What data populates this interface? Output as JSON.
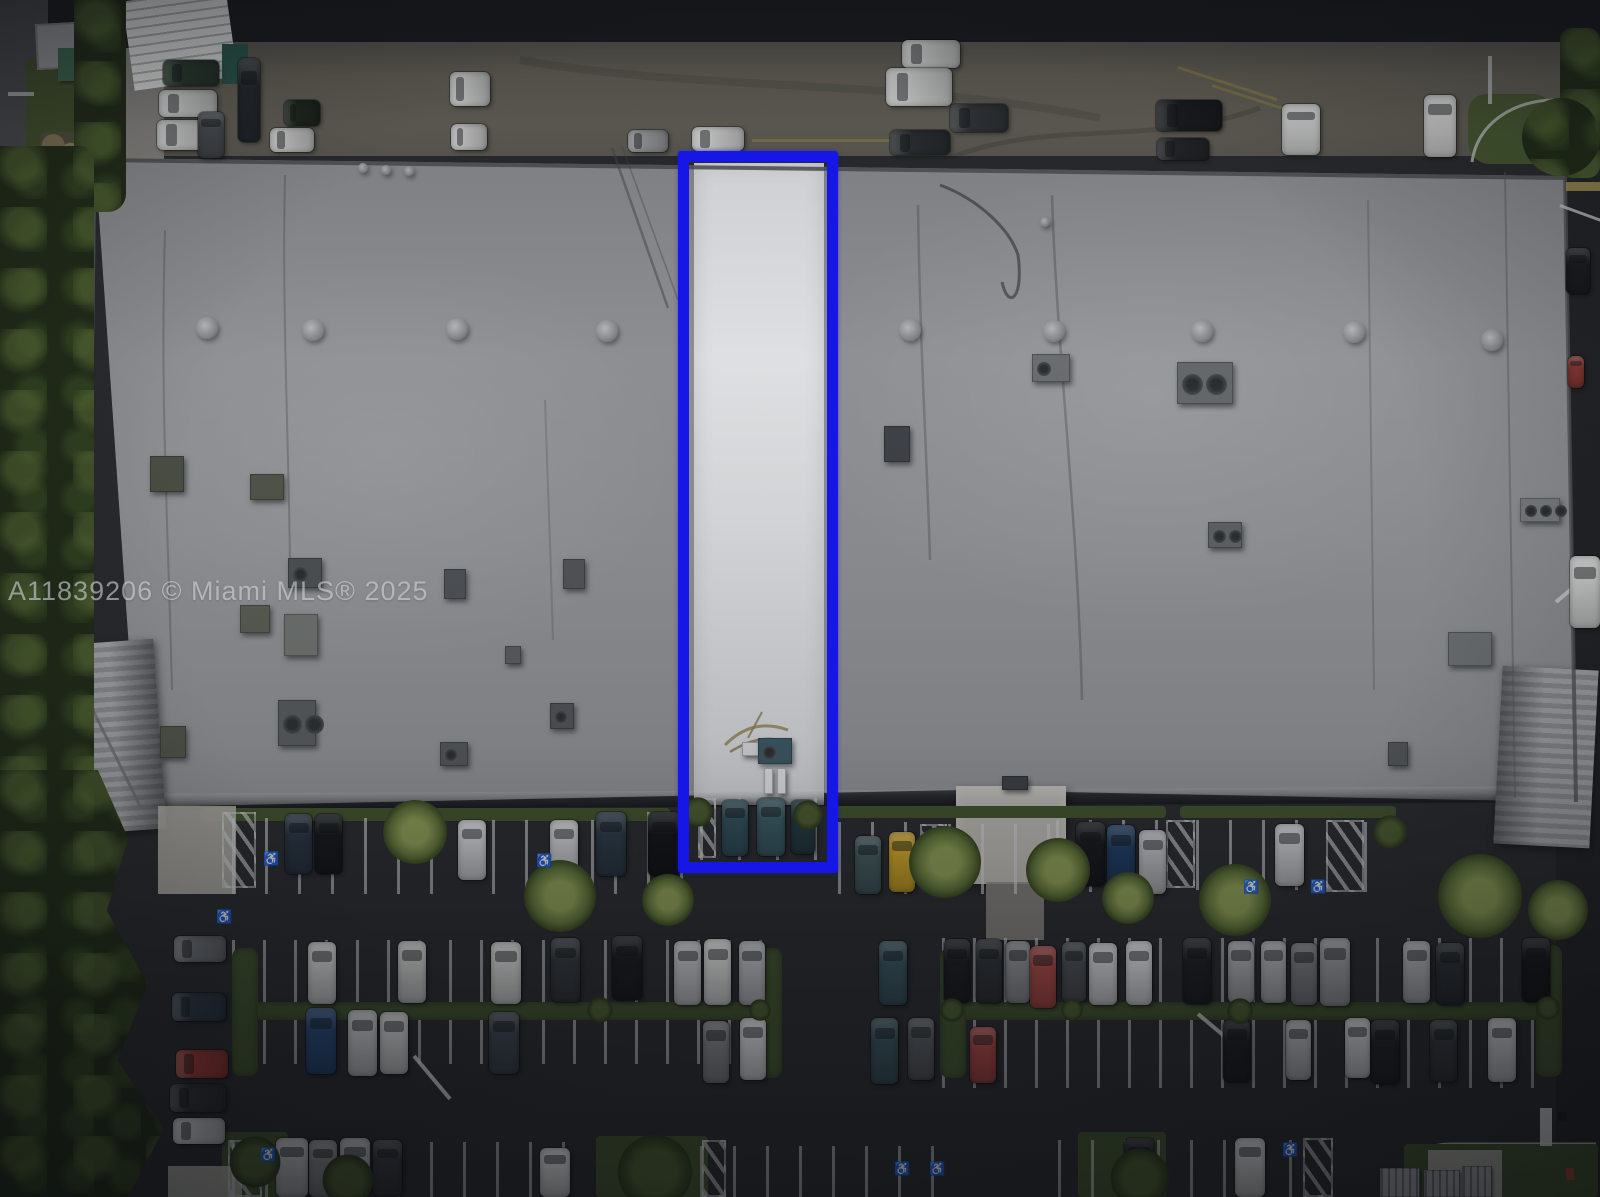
{
  "watermark": {
    "text": "A11839206 © Miami MLS® 2025"
  },
  "colors": {
    "asphalt_road": "#1b1d20",
    "asphalt_lot": "#2a2c30",
    "apron": "#686459",
    "roof": "#919396",
    "roof_white": "#e4e6e8",
    "blue": "#1617e6",
    "grass": "#41522e",
    "tree": "#232d19",
    "stripe": "#c9ccce",
    "canopy": "#9b9d9f",
    "concrete": "#b0aea6",
    "watermark_color": "#cdd2d6"
  },
  "highlight_unit": {
    "x": 678,
    "y": 151,
    "w": 160,
    "h": 722,
    "border_px": 11
  },
  "scene": {
    "stripes": [
      [
        232,
        818,
        230,
        76,
        33
      ],
      [
        492,
        820,
        120,
        74,
        33
      ],
      [
        614,
        812,
        80,
        82,
        33
      ],
      [
        700,
        798,
        118,
        62,
        38
      ],
      [
        838,
        822,
        82,
        72,
        33
      ],
      [
        948,
        824,
        108,
        70,
        33
      ],
      [
        1056,
        820,
        116,
        72,
        33
      ],
      [
        1196,
        820,
        130,
        70,
        33
      ],
      [
        1364,
        822,
        32,
        70,
        33
      ],
      [
        232,
        940,
        534,
        66,
        31
      ],
      [
        942,
        938,
        616,
        70,
        31
      ],
      [
        232,
        1004,
        534,
        60,
        31
      ],
      [
        942,
        1018,
        616,
        70,
        31
      ],
      [
        232,
        1142,
        362,
        55,
        33
      ],
      [
        700,
        1146,
        262,
        51,
        33
      ],
      [
        1058,
        1140,
        260,
        57,
        33
      ]
    ],
    "hatches": [
      [
        222,
        812,
        34,
        76
      ],
      [
        920,
        824,
        27,
        64
      ],
      [
        1166,
        820,
        29,
        68
      ],
      [
        1326,
        820,
        38,
        72
      ],
      [
        698,
        798,
        18,
        60
      ],
      [
        228,
        1140,
        34,
        57
      ],
      [
        702,
        1140,
        24,
        57
      ],
      [
        1303,
        1138,
        30,
        59
      ]
    ],
    "medians": [
      [
        232,
        1002,
        534,
        18
      ],
      [
        940,
        1002,
        618,
        18
      ]
    ],
    "median_caps": [
      [
        232,
        948,
        26,
        128
      ],
      [
        756,
        948,
        26,
        130
      ],
      [
        940,
        948,
        26,
        130
      ],
      [
        1536,
        945,
        26,
        132
      ]
    ],
    "grass_patches": [
      [
        200,
        808,
        470,
        13
      ],
      [
        836,
        806,
        330,
        12
      ],
      [
        1180,
        806,
        216,
        12
      ],
      [
        596,
        1136,
        112,
        61
      ],
      [
        1078,
        1132,
        88,
        65
      ],
      [
        222,
        1132,
        66,
        65
      ],
      [
        1404,
        1144,
        194,
        53
      ]
    ],
    "concrete_patches": [
      [
        158,
        806,
        78,
        88
      ],
      [
        168,
        1166,
        74,
        31
      ],
      [
        1428,
        1150,
        74,
        47
      ]
    ],
    "cars": [
      [
        163,
        60,
        56,
        26,
        "#2c3d30"
      ],
      [
        159,
        90,
        58,
        27,
        "#d6d7d5"
      ],
      [
        157,
        120,
        58,
        30,
        "#d0d1cf"
      ],
      [
        238,
        58,
        22,
        84,
        "#262b2f"
      ],
      [
        198,
        112,
        26,
        46,
        "#4a4e52"
      ],
      [
        284,
        100,
        36,
        26,
        "#20291f"
      ],
      [
        270,
        128,
        44,
        24,
        "#cfd0ce"
      ],
      [
        628,
        130,
        40,
        22,
        "#9a9c9e"
      ],
      [
        692,
        127,
        52,
        24,
        "#d4d5d3"
      ],
      [
        450,
        72,
        40,
        34,
        "#dadbd9"
      ],
      [
        451,
        124,
        36,
        26,
        "#cdcecc"
      ],
      [
        902,
        40,
        58,
        28,
        "#d7d8d6"
      ],
      [
        886,
        68,
        66,
        38,
        "#dddedc"
      ],
      [
        950,
        104,
        58,
        28,
        "#33373b"
      ],
      [
        890,
        130,
        60,
        25,
        "#2b2f33"
      ],
      [
        1156,
        100,
        66,
        31,
        "#1a1c1f"
      ],
      [
        1157,
        138,
        52,
        22,
        "#24272a"
      ],
      [
        1282,
        104,
        38,
        51,
        "#d9dad8"
      ],
      [
        1424,
        95,
        32,
        62,
        "#e1e1df"
      ],
      [
        1566,
        248,
        24,
        46,
        "#1b1e21"
      ],
      [
        1568,
        356,
        16,
        32,
        "#8c3a34"
      ],
      [
        1570,
        556,
        30,
        72,
        "#d8d9d7"
      ],
      [
        285,
        814,
        27,
        60,
        "#2a3542"
      ],
      [
        315,
        814,
        27,
        60,
        "#17191c"
      ],
      [
        458,
        820,
        28,
        60,
        "#cbccce"
      ],
      [
        550,
        820,
        28,
        60,
        "#c7c8ca"
      ],
      [
        596,
        812,
        30,
        64,
        "#2c3a46"
      ],
      [
        648,
        812,
        32,
        64,
        "#131518"
      ],
      [
        722,
        800,
        26,
        56,
        "#32505a"
      ],
      [
        757,
        798,
        28,
        58,
        "#3a5a64"
      ],
      [
        791,
        800,
        24,
        54,
        "#263a42"
      ],
      [
        855,
        836,
        26,
        58,
        "#42585a"
      ],
      [
        889,
        832,
        26,
        60,
        "#c9a227"
      ],
      [
        1076,
        822,
        29,
        64,
        "#17191c"
      ],
      [
        1107,
        825,
        28,
        66,
        "#1f3c60"
      ],
      [
        1139,
        830,
        27,
        64,
        "#b6b8ba"
      ],
      [
        1275,
        824,
        29,
        62,
        "#c3c4c6"
      ],
      [
        308,
        942,
        28,
        62,
        "#d2d3d1"
      ],
      [
        398,
        941,
        28,
        62,
        "#c9cac8"
      ],
      [
        491,
        942,
        30,
        62,
        "#cfd0ce"
      ],
      [
        551,
        938,
        29,
        64,
        "#34383c"
      ],
      [
        612,
        936,
        30,
        64,
        "#1a1d20"
      ],
      [
        674,
        941,
        27,
        64,
        "#c2c3c5"
      ],
      [
        704,
        939,
        27,
        66,
        "#d7d8d6"
      ],
      [
        739,
        941,
        26,
        64,
        "#b8babc"
      ],
      [
        879,
        941,
        28,
        64,
        "#39545d"
      ],
      [
        944,
        939,
        26,
        64,
        "#1c1f22"
      ],
      [
        976,
        939,
        26,
        64,
        "#2f3337"
      ],
      [
        1006,
        941,
        24,
        62,
        "#8d8f91"
      ],
      [
        1030,
        946,
        26,
        62,
        "#a84a47"
      ],
      [
        1062,
        942,
        24,
        60,
        "#4b4f53"
      ],
      [
        1089,
        943,
        28,
        62,
        "#ced0d2"
      ],
      [
        1126,
        941,
        26,
        64,
        "#d7d9db"
      ],
      [
        1183,
        938,
        28,
        66,
        "#1e2124"
      ],
      [
        1228,
        941,
        26,
        62,
        "#adafb1"
      ],
      [
        1261,
        941,
        25,
        62,
        "#b3b5b7"
      ],
      [
        1291,
        943,
        26,
        62,
        "#7d7f81"
      ],
      [
        1320,
        938,
        30,
        68,
        "#9ea0a2"
      ],
      [
        1403,
        941,
        27,
        62,
        "#b6b7b9"
      ],
      [
        1436,
        943,
        28,
        62,
        "#2c3034"
      ],
      [
        1522,
        938,
        28,
        64,
        "#17191c"
      ],
      [
        306,
        1008,
        30,
        66,
        "#2b4a78"
      ],
      [
        348,
        1010,
        29,
        66,
        "#c6c7c9"
      ],
      [
        380,
        1012,
        28,
        62,
        "#cfd0ce"
      ],
      [
        489,
        1012,
        30,
        62,
        "#3e454e"
      ],
      [
        703,
        1021,
        26,
        62,
        "#7f8183"
      ],
      [
        740,
        1018,
        26,
        62,
        "#d1d2d4"
      ],
      [
        871,
        1018,
        27,
        66,
        "#38525a"
      ],
      [
        908,
        1018,
        26,
        62,
        "#55595d"
      ],
      [
        970,
        1027,
        26,
        56,
        "#a64643"
      ],
      [
        1223,
        1020,
        27,
        62,
        "#1d2023"
      ],
      [
        1286,
        1020,
        25,
        60,
        "#b6b8ba"
      ],
      [
        1345,
        1018,
        25,
        60,
        "#d4d5d7"
      ],
      [
        1371,
        1020,
        28,
        64,
        "#212427"
      ],
      [
        1430,
        1020,
        27,
        62,
        "#34383c"
      ],
      [
        1488,
        1018,
        28,
        64,
        "#ced0d2"
      ],
      [
        174,
        936,
        52,
        26,
        "#6b6f73"
      ],
      [
        172,
        993,
        54,
        28,
        "#2d3b44"
      ],
      [
        176,
        1050,
        52,
        28,
        "#a03a36"
      ],
      [
        170,
        1084,
        56,
        28,
        "#2f3236"
      ],
      [
        173,
        1118,
        52,
        26,
        "#c8c9cb"
      ],
      [
        540,
        1148,
        30,
        49,
        "#d8d9d7"
      ],
      [
        276,
        1138,
        32,
        59,
        "#b9bbbd"
      ],
      [
        309,
        1140,
        28,
        57,
        "#85878a"
      ],
      [
        340,
        1138,
        30,
        59,
        "#aeb0b2"
      ],
      [
        373,
        1140,
        29,
        57,
        "#34383c"
      ],
      [
        1124,
        1138,
        30,
        59,
        "#191c1f"
      ],
      [
        1235,
        1138,
        30,
        59,
        "#d1d2d0"
      ]
    ],
    "vents": [
      [
        207,
        328
      ],
      [
        313,
        330
      ],
      [
        457,
        329
      ],
      [
        607,
        331
      ],
      [
        910,
        330
      ],
      [
        1054,
        331
      ],
      [
        1202,
        331
      ],
      [
        1354,
        332
      ],
      [
        1492,
        340
      ]
    ],
    "small_vents": [
      [
        363,
        168
      ],
      [
        386,
        170
      ],
      [
        409,
        171
      ],
      [
        107,
        162
      ],
      [
        117,
        165
      ],
      [
        1045,
        222
      ]
    ],
    "hvac": [
      [
        150,
        456,
        34,
        36,
        "#4d5246",
        0
      ],
      [
        250,
        474,
        34,
        26,
        "#53584c",
        0
      ],
      [
        288,
        558,
        34,
        30,
        "#505456",
        1
      ],
      [
        240,
        605,
        30,
        28,
        "#5c6055",
        0
      ],
      [
        284,
        614,
        34,
        42,
        "#717572",
        0
      ],
      [
        278,
        700,
        38,
        46,
        "#595d60",
        2
      ],
      [
        160,
        726,
        26,
        32,
        "#53564a",
        0
      ],
      [
        440,
        742,
        28,
        24,
        "#56595c",
        1
      ],
      [
        444,
        569,
        22,
        30,
        "#52565a",
        0
      ],
      [
        563,
        559,
        22,
        30,
        "#55585b",
        0
      ],
      [
        550,
        703,
        24,
        26,
        "#52555a",
        1
      ],
      [
        505,
        646,
        16,
        18,
        "#5d6063",
        0
      ],
      [
        1032,
        354,
        38,
        28,
        "#6d7174",
        1
      ],
      [
        1177,
        362,
        56,
        42,
        "#686c6f",
        2
      ],
      [
        884,
        426,
        26,
        36,
        "#41454a",
        0
      ],
      [
        1208,
        522,
        34,
        26,
        "#626669",
        2
      ],
      [
        1520,
        498,
        40,
        24,
        "#7e8285",
        3
      ],
      [
        1448,
        632,
        44,
        34,
        "#717578",
        0
      ],
      [
        1388,
        742,
        20,
        24,
        "#56595c",
        0
      ],
      [
        742,
        742,
        28,
        14,
        "#d8dadc",
        0
      ],
      [
        758,
        738,
        34,
        26,
        "#3e5a66",
        1
      ],
      [
        764,
        768,
        9,
        26,
        "#e2e4e6",
        0
      ],
      [
        777,
        768,
        9,
        26,
        "#e2e4e6",
        0
      ],
      [
        1002,
        776,
        26,
        14,
        "#3e4246",
        0
      ],
      [
        1380,
        1168,
        40,
        29,
        "pad",
        0
      ],
      [
        1424,
        1170,
        36,
        27,
        "pad",
        0
      ],
      [
        1462,
        1166,
        30,
        31,
        "pad",
        0
      ]
    ],
    "palms": [
      [
        415,
        832,
        32
      ],
      [
        560,
        896,
        36
      ],
      [
        668,
        900,
        26
      ],
      [
        945,
        862,
        36
      ],
      [
        1058,
        870,
        32
      ],
      [
        1128,
        898,
        26
      ],
      [
        1235,
        900,
        36
      ],
      [
        1480,
        896,
        42
      ],
      [
        1558,
        910,
        30
      ]
    ],
    "bushes": [
      [
        698,
        812,
        15
      ],
      [
        808,
        815,
        15
      ],
      [
        1390,
        832,
        17
      ],
      [
        655,
        1172,
        38
      ],
      [
        1140,
        1178,
        30
      ],
      [
        255,
        1162,
        26
      ],
      [
        348,
        1180,
        26
      ],
      [
        600,
        1010,
        13
      ],
      [
        760,
        1010,
        11
      ],
      [
        952,
        1010,
        12
      ],
      [
        1072,
        1010,
        11
      ],
      [
        1240,
        1011,
        13
      ],
      [
        1548,
        1008,
        12
      ]
    ],
    "handicaps": [
      [
        263,
        852
      ],
      [
        536,
        854
      ],
      [
        216,
        910
      ],
      [
        1243,
        880
      ],
      [
        1310,
        880
      ],
      [
        260,
        1148
      ],
      [
        894,
        1162
      ],
      [
        929,
        1162
      ],
      [
        1282,
        1143
      ]
    ],
    "marks": [
      [
        752,
        139,
        188,
        3,
        "#a59343",
        0,
        0.45
      ],
      [
        1178,
        66,
        104,
        3,
        "#a59343",
        18,
        0.5
      ],
      [
        1212,
        84,
        100,
        3,
        "#a59343",
        18,
        0.45
      ],
      [
        1566,
        182,
        34,
        9,
        "#b7a15c",
        0,
        0.8
      ],
      [
        1430,
        120,
        18,
        3,
        "#a23f33",
        0,
        0.9
      ],
      [
        1430,
        127,
        13,
        3,
        "#a23f33",
        0,
        0.8
      ],
      [
        8,
        92,
        26,
        4,
        "#c9cbcd",
        0,
        0.7
      ],
      [
        1488,
        56,
        4,
        48,
        "#c6c8ca",
        0,
        0.8
      ],
      [
        414,
        1054,
        56,
        4,
        "#d2d4d6",
        50,
        0.85
      ],
      [
        1198,
        1012,
        64,
        4,
        "#d0d2d4",
        40,
        0.8
      ],
      [
        1560,
        204,
        46,
        3,
        "#cfd1d3",
        20,
        0.8
      ],
      [
        1540,
        1108,
        12,
        38,
        "#d6d8da",
        0,
        0.9
      ],
      [
        1557,
        1112,
        9,
        9,
        "#1a1c1e",
        0,
        0.9
      ],
      [
        1566,
        1168,
        8,
        12,
        "#a84438",
        0,
        0.9
      ],
      [
        1556,
        600,
        40,
        4,
        "#cfd1d3",
        -40,
        0.9
      ]
    ]
  }
}
